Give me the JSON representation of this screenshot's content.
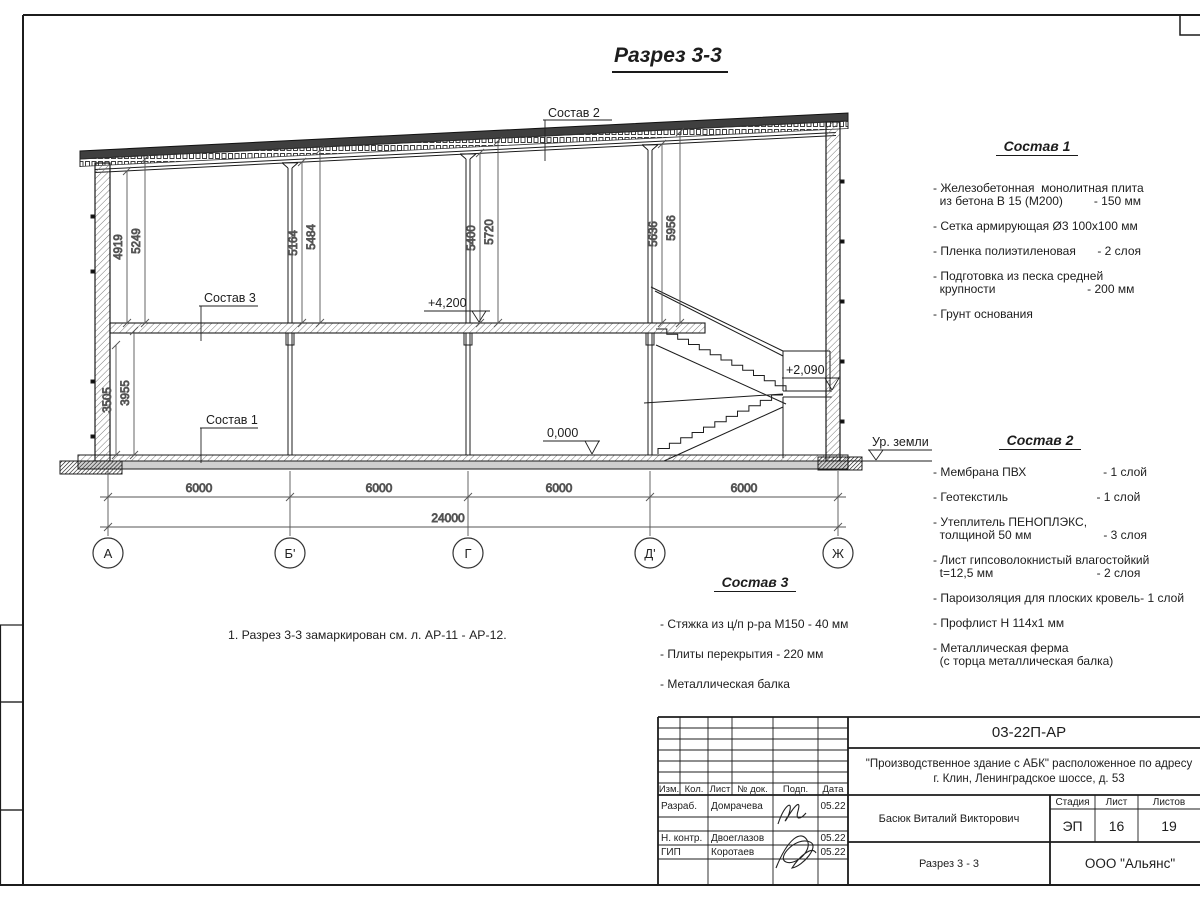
{
  "drawing": {
    "title": "Разрез 3-3",
    "axes": [
      "А",
      "Б'",
      "Г",
      "Д'",
      "Ж"
    ],
    "spans": [
      "6000",
      "6000",
      "6000",
      "6000"
    ],
    "total": "24000",
    "heights_upper": [
      "4919",
      "5249",
      "5164",
      "5484",
      "5400",
      "5720",
      "5636",
      "5956"
    ],
    "heights_lower": [
      "3505",
      "3955"
    ],
    "level_floor2": "+4,200",
    "level_landing": "+2,090",
    "level_zero": "0,000",
    "ground_label": "Ур. земли",
    "leader_sostav1": "Состав 1",
    "leader_sostav2": "Состав 2",
    "leader_sostav3": "Состав 3"
  },
  "note": "1. Разрез 3-3 замаркирован см. л. АР-11 - АР-12.",
  "legend1": {
    "heading": "Состав 1",
    "lines": [
      {
        "l": "- Железобетонная  монолитная плита",
        "r": ""
      },
      {
        "l": "  из бетона В 15 (М200)",
        "r": "- 150 мм"
      },
      {
        "l": "- Сетка армирующая Ø3 100x100 мм",
        "r": ""
      },
      {
        "l": "- Пленка полиэтиленовая",
        "r": "- 2 слоя"
      },
      {
        "l": "- Подготовка из песка средней",
        "r": ""
      },
      {
        "l": "  крупности",
        "r": "- 200 мм  "
      },
      {
        "l": "- Грунт основания",
        "r": ""
      }
    ]
  },
  "legend2": {
    "heading": "Состав 2",
    "lines": [
      {
        "l": "- Мембрана ПВХ",
        "r": "- 1 слой"
      },
      {
        "l": "- Геотекстиль",
        "r": "- 1 слой  "
      },
      {
        "l": "- Утеплитель ПЕНОПЛЭКС,",
        "r": ""
      },
      {
        "l": "  толщиной 50 мм",
        "r": "- 3 слоя"
      },
      {
        "l": "- Лист гипсоволокнистый влагостойкий",
        "r": ""
      },
      {
        "l": "  t=12,5 мм",
        "r": "- 2 слоя  "
      },
      {
        "l": "- Пароизоляция для плоских кровель",
        "r": "- 1 слой"
      },
      {
        "l": "- Профлист Н 114x1 мм",
        "r": ""
      },
      {
        "l": "- Металлическая ферма",
        "r": ""
      },
      {
        "l": "  (с торца металлическая балка)",
        "r": ""
      }
    ]
  },
  "legend3": {
    "heading": "Состав 3",
    "lines": [
      {
        "l": "- Стяжка из ц/п р-ра М150 - 40 мм",
        "r": ""
      },
      {
        "l": "- Плиты перекрытия - 220 мм",
        "r": ""
      },
      {
        "l": "- Металлическая балка",
        "r": ""
      }
    ]
  },
  "titleblock": {
    "doc_code": "03-22П-АР",
    "project_line1": "\"Производственное здание с АБК\" расположенное по адресу",
    "project_line2": "г. Клин, Ленинградское шоссе, д. 53",
    "col_izm": "Изм.",
    "col_kol": "Кол.",
    "col_list": "Лист",
    "col_ndok": "№ док.",
    "col_podp": "Подп.",
    "col_data": "Дата",
    "rows": [
      {
        "role": "Разраб.",
        "name": "Домрачева",
        "date": "05.22"
      },
      {
        "role": "Н. контр.",
        "name": "Двоеглазов",
        "date": "05.22"
      },
      {
        "role": "ГИП",
        "name": "Коротаев",
        "date": "05.22"
      }
    ],
    "approver": "Басюк Виталий Викторович",
    "sheet_title": "Разрез 3 - 3",
    "stage_label": "Стадия",
    "sheet_label": "Лист",
    "sheets_label": "Листов",
    "stage": "ЭП",
    "sheet_no": "16",
    "sheets_total": "19",
    "company": "ООО \"Альянс\""
  }
}
